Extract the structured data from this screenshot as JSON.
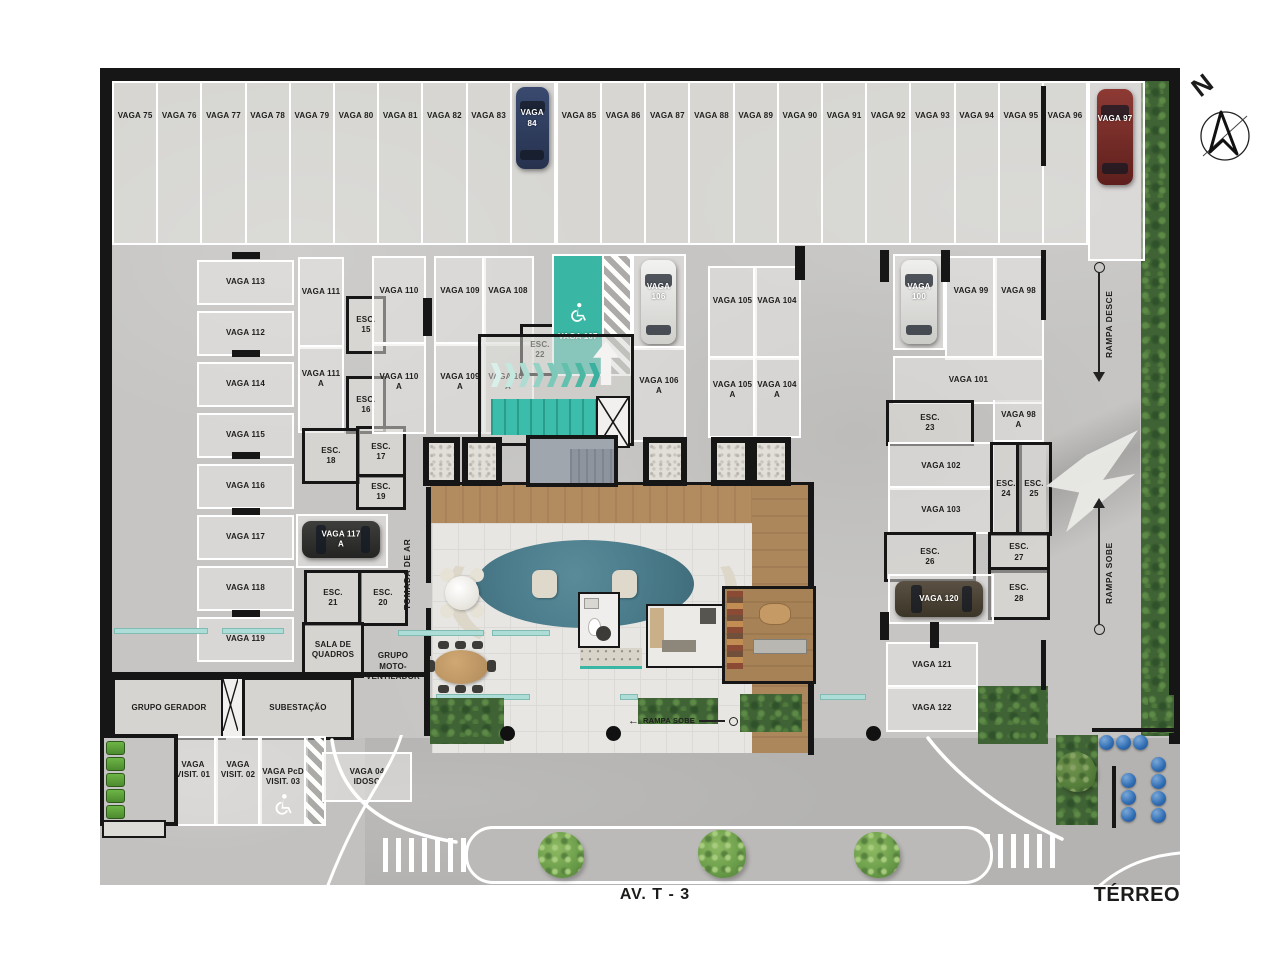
{
  "title": "TÉRREO",
  "street": {
    "name": "AV. T - 3"
  },
  "compass": {
    "north": "N"
  },
  "ramps": {
    "desce": "RAMPA DESCE",
    "sobe": "RAMPA SOBE",
    "sobe_lobby": "RAMPA SOBE"
  },
  "top_row": {
    "stalls_a": [
      "VAGA 75",
      "VAGA 76",
      "VAGA 77",
      "VAGA 78",
      "VAGA 79",
      "VAGA 80",
      "VAGA 81",
      "VAGA 82",
      "VAGA 83"
    ],
    "stall_84": "VAGA 84",
    "stalls_b": [
      "VAGA 85",
      "VAGA 86",
      "VAGA 87",
      "VAGA 88",
      "VAGA 89",
      "VAGA 90",
      "VAGA 91",
      "VAGA 92",
      "VAGA 93",
      "VAGA 94",
      "VAGA 95",
      "VAGA 96"
    ],
    "stall_97": "VAGA 97"
  },
  "left_column": {
    "stalls": [
      "VAGA 113",
      "VAGA 112",
      "VAGA 114",
      "VAGA 115",
      "VAGA 116",
      "VAGA 117",
      "VAGA 118",
      "VAGA 119"
    ]
  },
  "inner_left": {
    "vaga_111": "VAGA 111",
    "vaga_111a": "VAGA 111 A",
    "vaga_117a": "VAGA 117 A",
    "sala_quadros": "SALA DE QUADROS",
    "esc_15": "ESC. 15",
    "esc_16": "ESC. 16",
    "esc_17": "ESC. 17",
    "esc_18": "ESC. 18",
    "esc_19": "ESC. 19",
    "esc_20": "ESC. 20",
    "esc_21": "ESC. 21"
  },
  "center": {
    "vaga_110": "VAGA 110",
    "vaga_109": "VAGA 109",
    "vaga_108": "VAGA 108",
    "vaga_110a": "VAGA 110 A",
    "vaga_109a": "VAGA 109 A",
    "vaga_108a": "VAGA 108 A",
    "esc_22": "ESC. 22",
    "vaga_107": "VAGA 107",
    "vaga_106": "VAGA 106",
    "vaga_106a": "VAGA 106 A",
    "vaga_105": "VAGA 105",
    "vaga_104": "VAGA 104",
    "vaga_105a": "VAGA 105 A",
    "vaga_104a": "VAGA 104 A"
  },
  "right": {
    "vaga_100": "VAGA 100",
    "vaga_99": "VAGA 99",
    "vaga_98": "VAGA 98",
    "vaga_101": "VAGA 101",
    "vaga_98a": "VAGA 98 A",
    "esc_23": "ESC. 23",
    "vaga_102": "VAGA 102",
    "vaga_103": "VAGA 103",
    "esc_24": "ESC. 24",
    "esc_25": "ESC. 25",
    "esc_26": "ESC. 26",
    "esc_27": "ESC. 27",
    "esc_28": "ESC. 28",
    "vaga_120": "VAGA 120",
    "vaga_121": "VAGA 121",
    "vaga_122": "VAGA 122"
  },
  "rooms": {
    "grupo_gerador": "GRUPO GERADOR",
    "subestacao": "SUBESTAÇÃO",
    "grupo_moto_ventilador": "GRUPO MOTO-VENTILADOR",
    "tomada_de_ar": "TOMADA DE AR"
  },
  "visitors": {
    "v1": "VAGA VISIT. 01",
    "v2": "VAGA VISIT. 02",
    "v3": "VAGA PcD VISIT. 03",
    "v4": "VAGA 04 IDOSO"
  },
  "colors": {
    "accent_teal": "#3ab7a4",
    "wood": "#b08a5e",
    "hedge_green": "#47713a",
    "tank_blue": "#2f6cb3",
    "rug_blue": "#4e7f8d",
    "wall_black": "#161616"
  }
}
